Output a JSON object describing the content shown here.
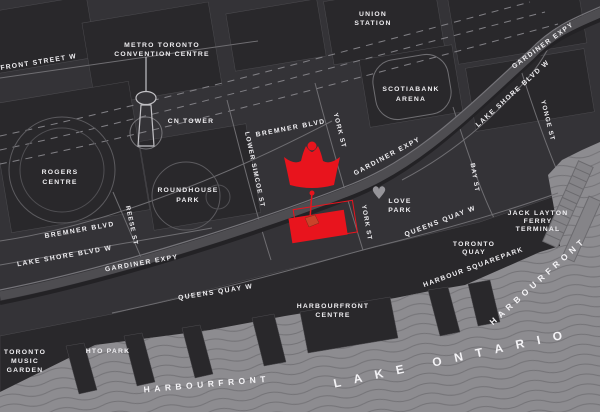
{
  "colors": {
    "accent_red": "#e8141d",
    "pin_orange": "#c9432a",
    "lake_gray": "#8d8c90",
    "land_dark": "#29282b",
    "background": "#343337",
    "label_text": "#efeef1",
    "heart_gray": "#96959a"
  },
  "labels": {
    "front_street": "FRONT STREET W",
    "mtcc": [
      "METRO TORONTO",
      "CONVENTION CENTRE"
    ],
    "union": [
      "UNION",
      "STATION"
    ],
    "cn_tower": "CN TOWER",
    "rogers": [
      "ROGERS",
      "CENTRE"
    ],
    "roundhouse": [
      "ROUNDHOUSE",
      "PARK"
    ],
    "scotiabank": [
      "SCOTIABANK",
      "ARENA"
    ],
    "bremner_w": "BREMNER BLVD",
    "bremner_e": "BREMNER BLVD",
    "lakeshore_w": "LAKE SHORE BLVD W",
    "lakeshore_e": "LAKE SHORE BLVD W",
    "gardiner_w": "GARDINER EXPY",
    "gardiner_mid": "GARDINER EXPY",
    "gardiner_top": "GARDINER EXPY",
    "lower_simcoe": "LOWER SIMCOE ST",
    "reese": "REESE ST",
    "york_n": "YORK ST",
    "york_s": "YORK ST",
    "bay": "BAY ST",
    "yonge": "YONGE ST",
    "queens_quay_w": "QUEENS QUAY W",
    "queens_quay_e": "QUEENS QUAY W",
    "love_park": [
      "LOVE",
      "PARK"
    ],
    "jack_layton": [
      "JACK LAYTON",
      "FERRY",
      "TERMINAL"
    ],
    "toronto_quay": [
      "TORONTO",
      "QUAY"
    ],
    "harbour_square": "HARBOUR SQUAREPARK",
    "harbourfront_centre": [
      "HARBOURFRONT",
      "CENTRE"
    ],
    "hto_park": "HTO PARK",
    "music_garden": [
      "TORONTO",
      "MUSIC",
      "GARDEN"
    ],
    "harbourfront_sw": "HARBOURFRONT",
    "harbourfront_e": "HARBOURFRONT",
    "lake_ontario": "LAKE ONTARIO"
  }
}
